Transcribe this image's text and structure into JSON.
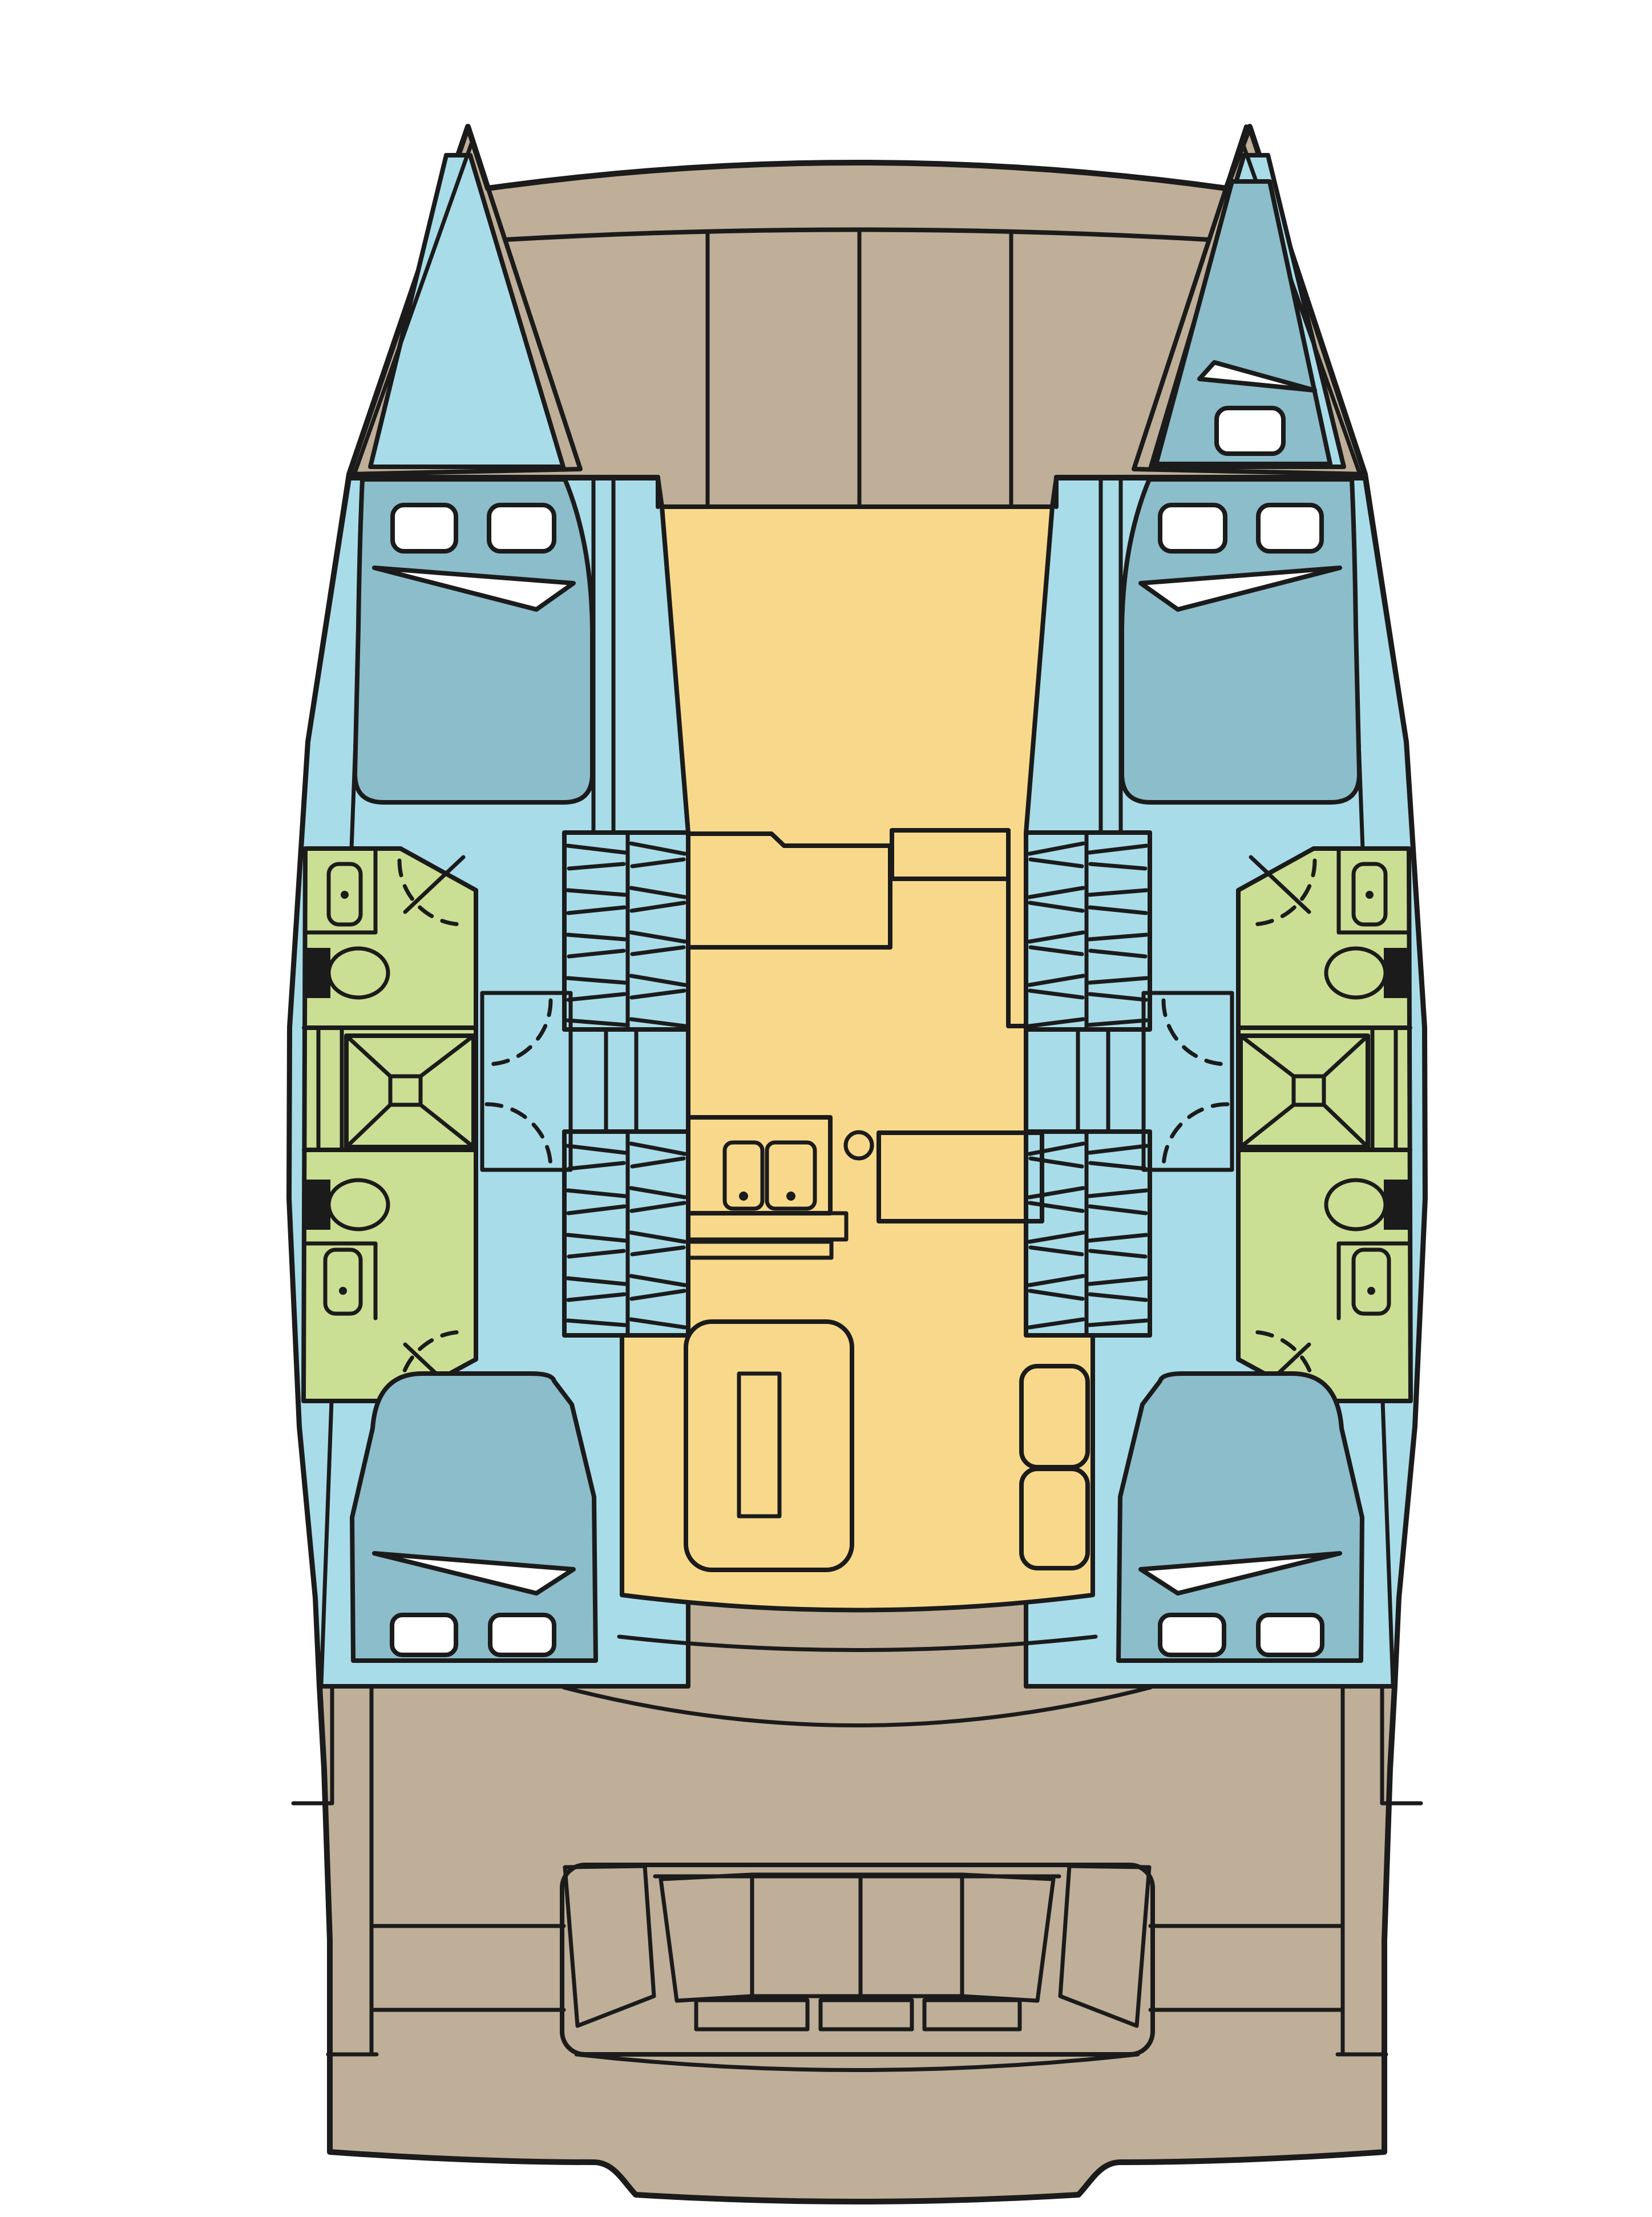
{
  "document": {
    "kind": "boat-floor-plan",
    "vessel_type": "catamaran",
    "view": "top-down deck and accommodation plan",
    "text_labels": []
  },
  "theme": {
    "deck": "#BFAF98",
    "hull": "#A9DCE9",
    "bed": "#8CBDCA",
    "wet": "#CBDF94",
    "salon": "#F8D98C",
    "line": "#1B1B1B",
    "paper": "#FFFFFF",
    "fixture": "#1B1B1B"
  },
  "regions": {
    "bow": [
      "port-forepeak-locker",
      "starboard-forepeak-berth",
      "foredeck"
    ],
    "port_hull": [
      "forward-double-cabin",
      "forward-bathroom",
      "shower",
      "aft-bathroom",
      "aft-double-cabin",
      "companionway-stairs"
    ],
    "starboard_hull": [
      "forward-double-cabin",
      "forward-bathroom",
      "shower",
      "aft-bathroom",
      "aft-double-cabin",
      "companionway-stairs"
    ],
    "salon": [
      "galley-counter",
      "galley-cabinet",
      "double-sink",
      "round-basin",
      "nav-counter",
      "dinette-table",
      "dinette-bench",
      "side-seats"
    ],
    "stern": [
      "cockpit",
      "u-shaped-bench",
      "swim-platforms",
      "transom"
    ]
  },
  "fixture_counts": {
    "double_beds": 4,
    "forepeak_berths": 1,
    "bathrooms": 4,
    "showers": 2,
    "toilets": 4,
    "washbasins": 4,
    "galley_sinks": 2,
    "deck_hatches": 9,
    "cockpit_back_cushions": 4,
    "cockpit_seat_cushions": 3
  }
}
